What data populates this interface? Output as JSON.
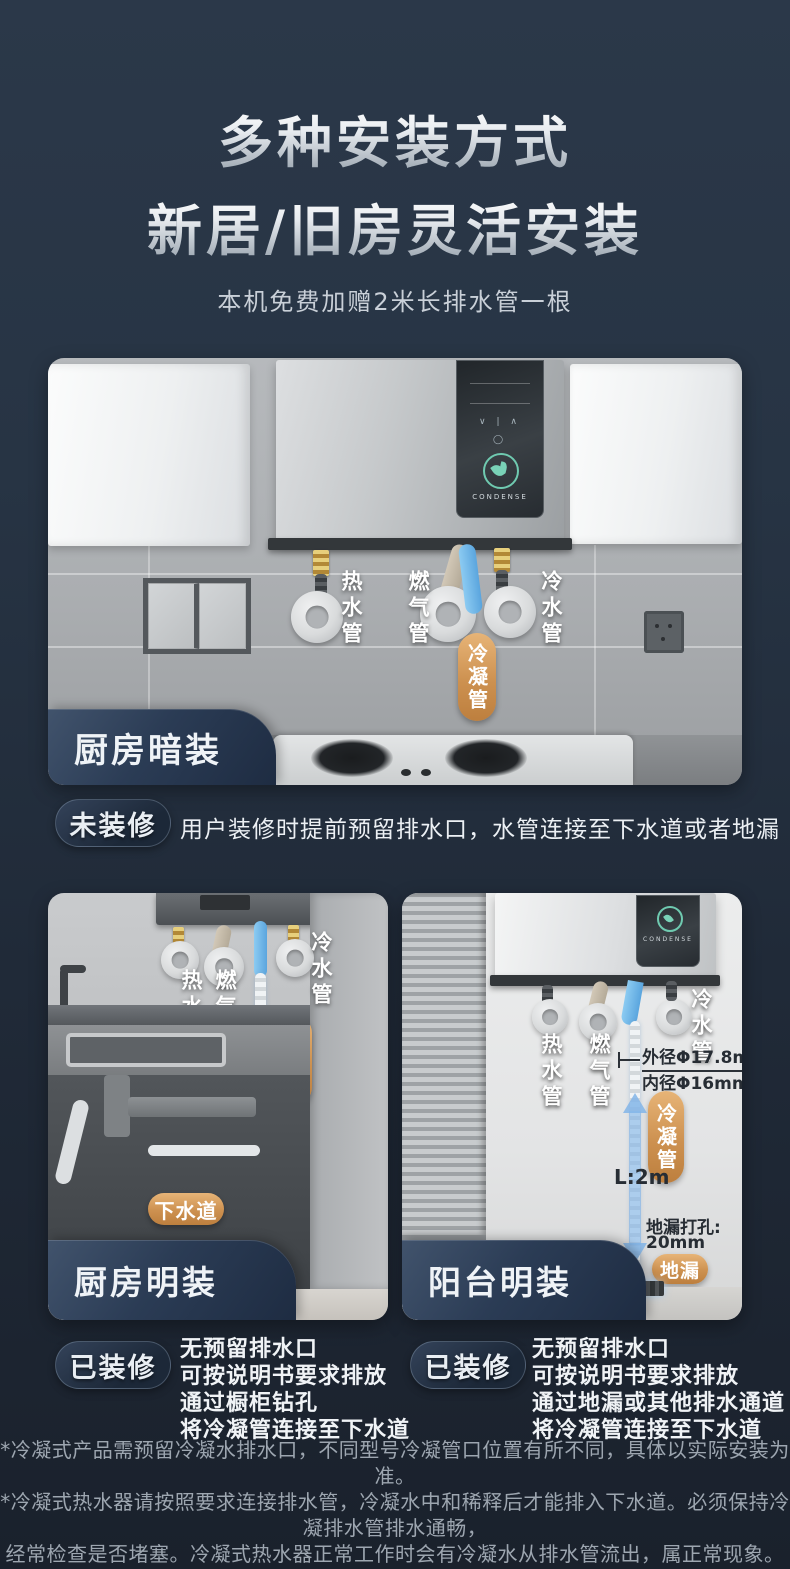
{
  "header": {
    "title_line1": "多种安装方式",
    "title_line2": "新居/旧房灵活安装",
    "subtitle": "本机免费加赠2米长排水管一根"
  },
  "colors": {
    "accent_gold": "#cd9150",
    "badge_navy": "#2b3c55",
    "background_navy": "#273444",
    "arrow_blue": "#82b5e8"
  },
  "scene_kitchen_hidden": {
    "badge": "厨房暗装",
    "brand": "CONDENSE",
    "labels": {
      "hot": "热水管",
      "gas": "燃气管",
      "cold": "冷水管",
      "condensate": "冷凝管"
    }
  },
  "row_not_renovated": {
    "tag": "未装修",
    "description": "用户装修时提前预留排水口，水管连接至下水道或者地漏"
  },
  "scene_kitchen_exposed": {
    "badge": "厨房明装",
    "labels": {
      "hot": "热水管",
      "gas": "燃气管",
      "cold": "冷水管",
      "condensate": "冷凝管",
      "drain": "下水道"
    }
  },
  "scene_balcony_exposed": {
    "badge": "阳台明装",
    "brand": "CONDENSE",
    "labels": {
      "hot": "热水管",
      "gas": "燃气管",
      "cold": "冷水管",
      "condensate": "冷凝管",
      "floor_drain": "地漏"
    },
    "annotations": {
      "outer_diameter": "外径Φ17.8mm",
      "inner_diameter": "内径Φ16mm",
      "length": "L:2m",
      "drill_label": "地漏打孔:",
      "drill_value": "20mm"
    }
  },
  "row_renovated_left": {
    "tag": "已装修",
    "lines": [
      "无预留排水口",
      "可按说明书要求排放",
      "通过橱柜钻孔",
      "将冷凝管连接至下水道"
    ]
  },
  "row_renovated_right": {
    "tag": "已装修",
    "lines": [
      "无预留排水口",
      "可按说明书要求排放",
      "通过地漏或其他排水通道",
      "将冷凝管连接至下水道"
    ]
  },
  "footnotes": {
    "lines": [
      "*冷凝式产品需预留冷凝水排水口，不同型号冷凝管口位置有所不同，具体以实际安装为准。",
      "*冷凝式热水器请按照要求连接排水管，冷凝水中和稀释后才能排入下水道。必须保持冷凝排水管排水通畅，",
      "经常检查是否堵塞。冷凝式热水器正常工作时会有冷凝水从排水管流出，属正常现象。冷凝水为酸性，",
      "不能作为一般用水，更不能饮用。",
      "注:8月12日后起冷凝管均迭代为外径17.8mm，内径16mm,长度2m规格管。"
    ]
  }
}
